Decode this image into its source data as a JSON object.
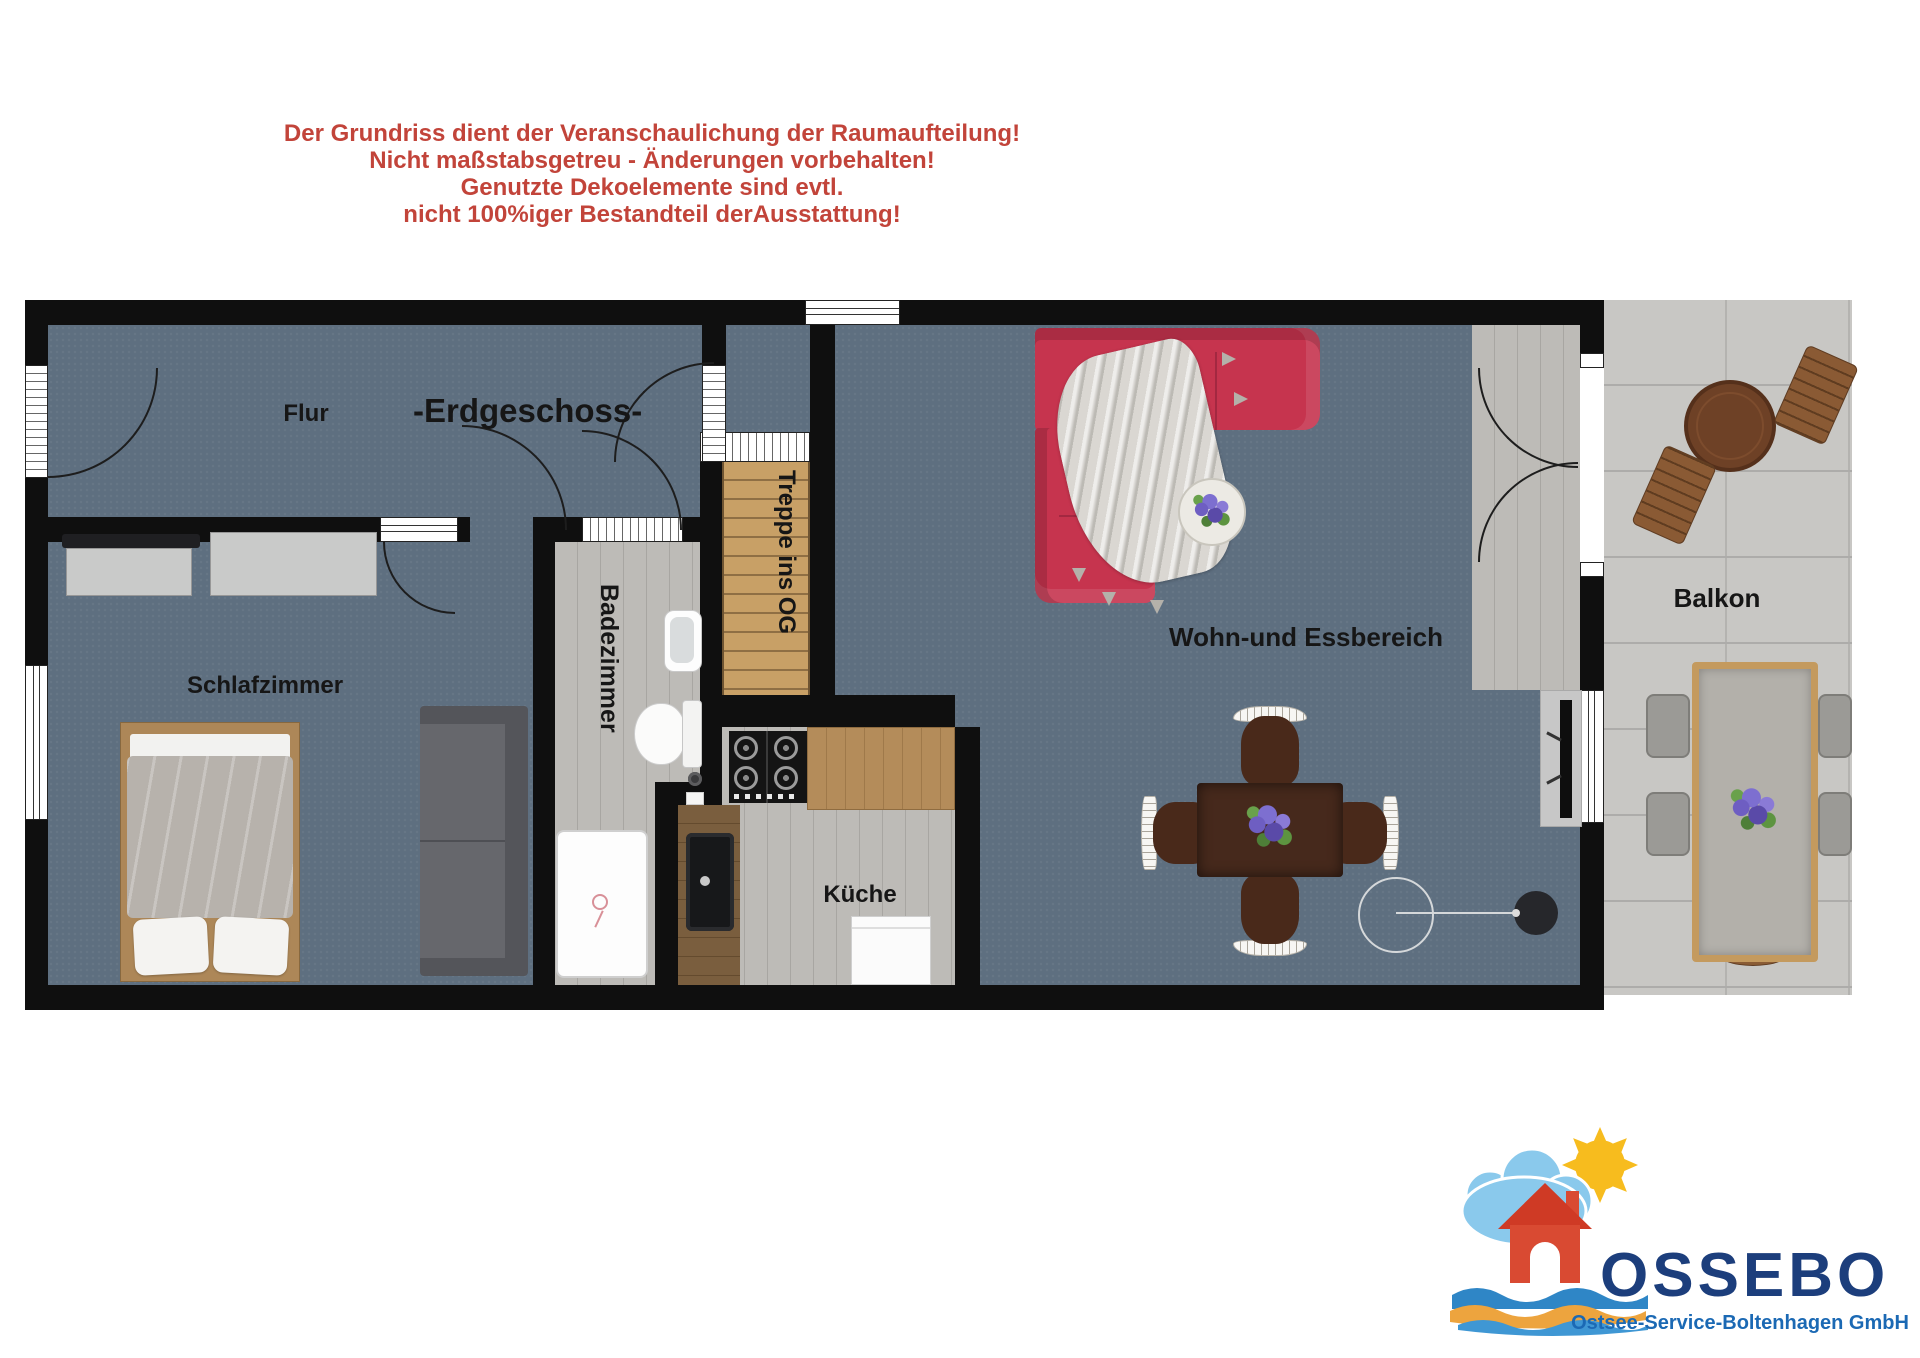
{
  "disclaimer": {
    "lines": [
      "Der Grundriss dient der Veranschaulichung der Raumaufteilung!",
      "Nicht maßstabsgetreu - Änderungen vorbehalten!",
      "Genutzte Dekoelemente sind evtl.",
      "nicht 100%iger Bestandteil derAusstattung!"
    ]
  },
  "plan": {
    "title": "-Erdgeschoss-",
    "rooms": {
      "flur": "Flur",
      "schlafzimmer": "Schlafzimmer",
      "badezimmer": "Badezimmer",
      "treppe": "Treppe ins OG",
      "kueche": "Küche",
      "wohnbereich": "Wohn-und Essbereich",
      "balkon": "Balkon"
    }
  },
  "logo": {
    "name": "OSSEBO",
    "tagline": "Ostsee-Service-Boltenhagen GmbH"
  },
  "colors": {
    "disclaimer_text": "#c2443a",
    "floor_main": "#5e6f80",
    "walls": "#0f0f0f",
    "sofa_red": "#c6344e",
    "stairs_wood": "#c8a066",
    "logo_navy": "#1c3e7c",
    "logo_blue": "#1b69b4"
  }
}
